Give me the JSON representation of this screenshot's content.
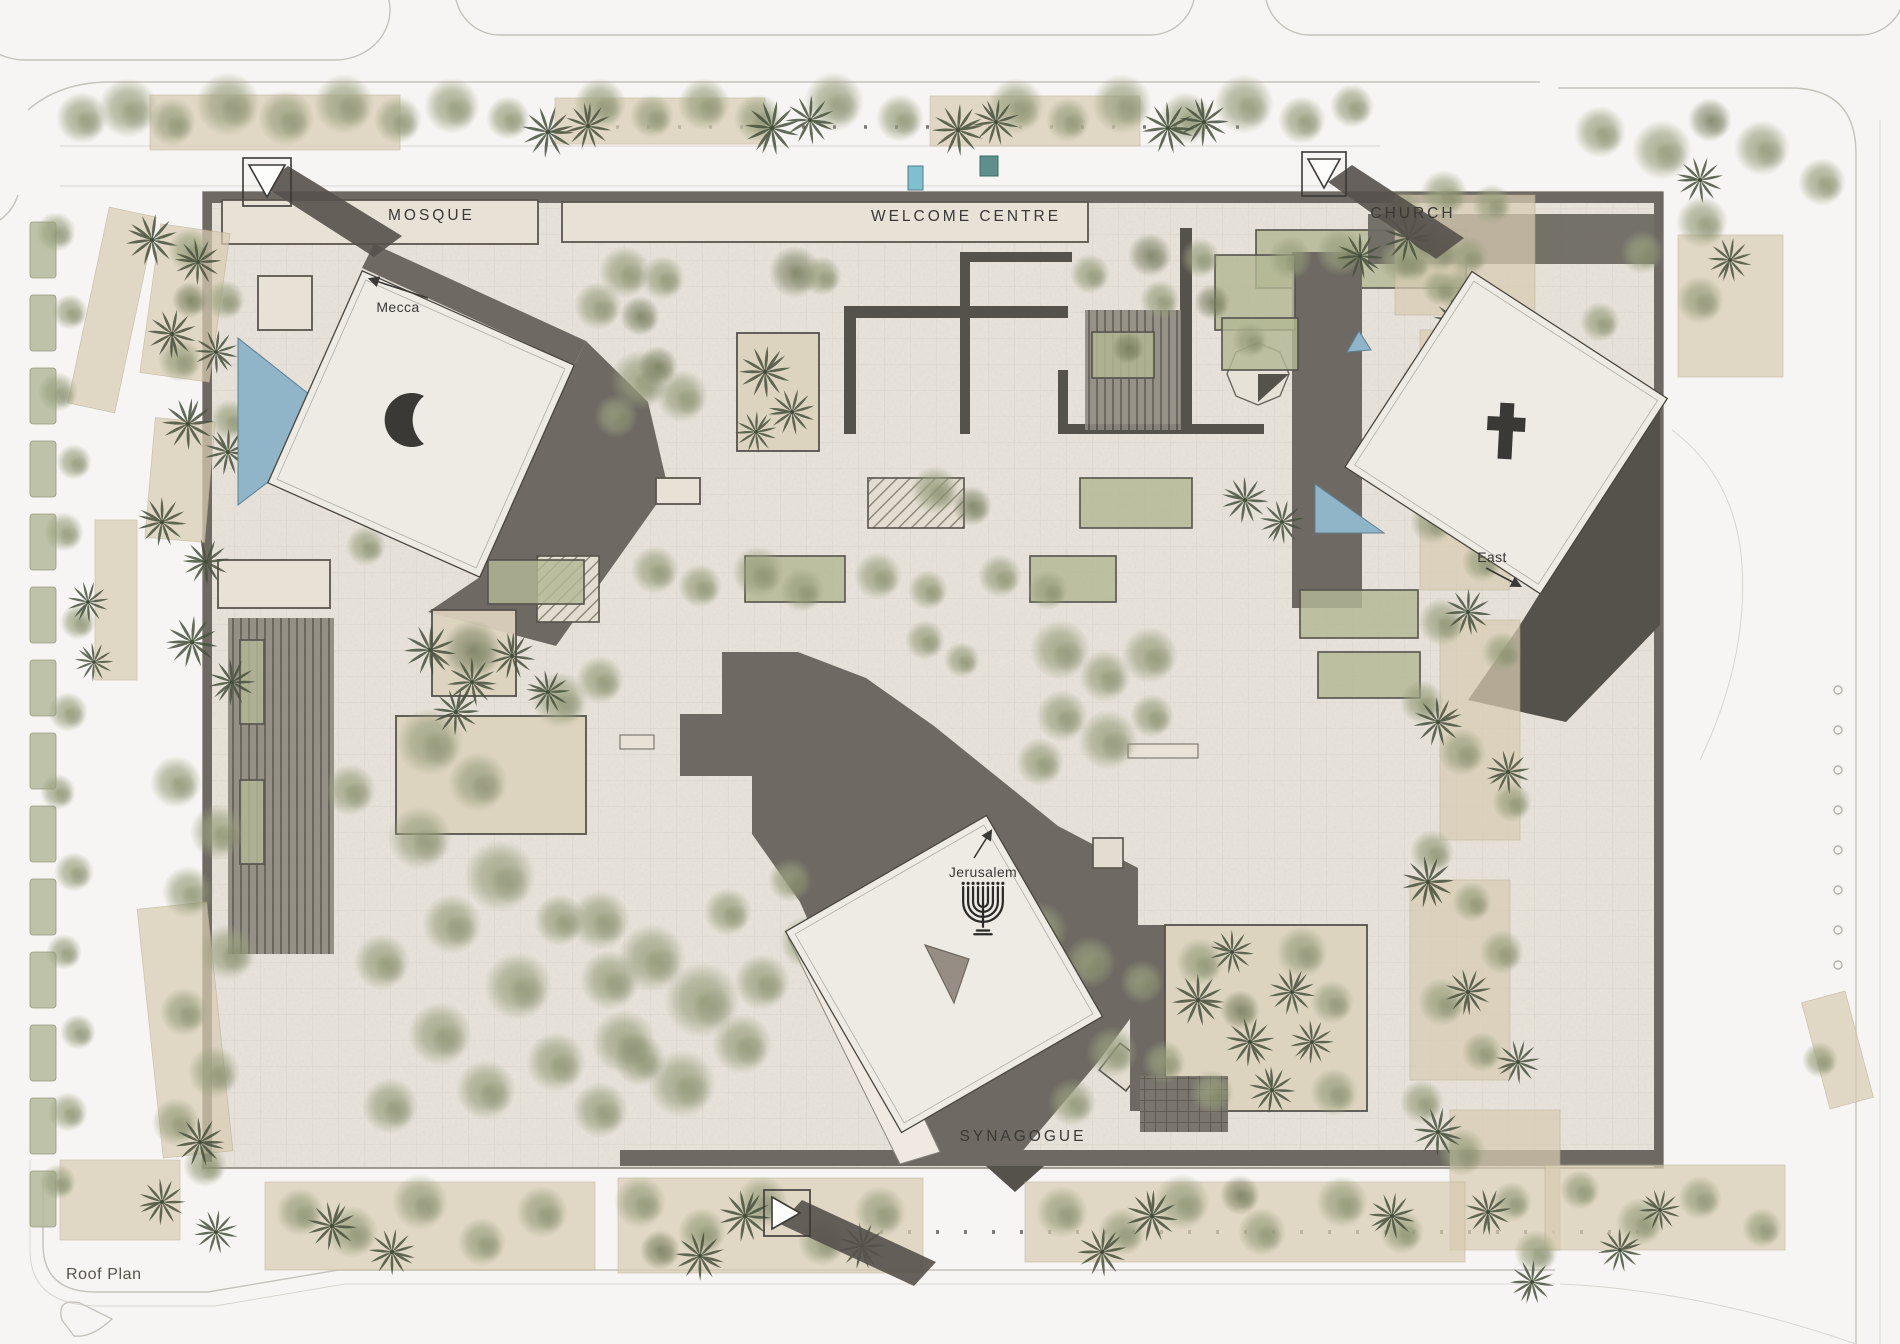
{
  "plan": {
    "title": "Roof Plan",
    "labels": {
      "mosque": "MOSQUE",
      "welcome_centre": "WELCOME CENTRE",
      "church": "CHURCH",
      "synagogue": "SYNAGOGUE",
      "mecca": "Mecca",
      "east": "East",
      "jerusalem": "Jerusalem",
      "roof_plan": "Roof Plan"
    },
    "symbols": {
      "mosque": "crescent-icon",
      "church": "cross-icon",
      "synagogue": "menorah-icon"
    },
    "colors": {
      "paper": "#f7f5f3",
      "platform": "#e9e4dc",
      "roofwhite": "#eeebe5",
      "roofdark": "#6e6a63",
      "shadow": "#55514b",
      "tree": "#99a07e",
      "treedark": "#737a5a",
      "palm": "#46503c",
      "water": "#90b4c8",
      "bed": "#d8ccb2",
      "ink": "#3a3936",
      "line": "#c6c2bc"
    }
  }
}
